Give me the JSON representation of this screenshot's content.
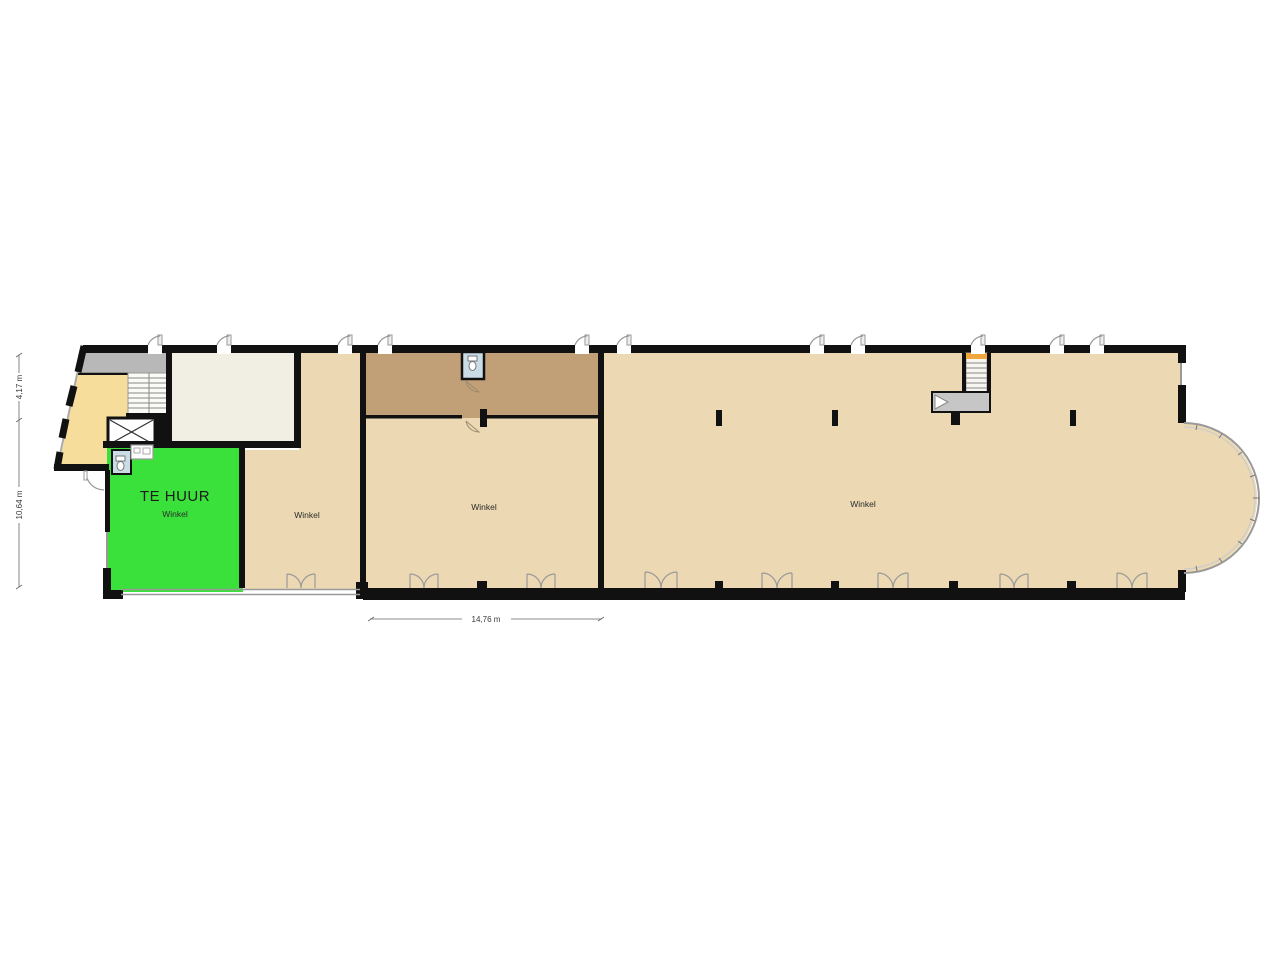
{
  "plan": {
    "rooms": {
      "te_huur": {
        "label": "TE HUUR",
        "sublabel": "Winkel"
      },
      "winkel_left": {
        "label": "Winkel"
      },
      "winkel_middle": {
        "label": "Winkel"
      },
      "winkel_right": {
        "label": "Winkel"
      }
    },
    "dimensions": {
      "upper_left": "4,17 m",
      "lower_left": "10,64 m",
      "bottom_middle": "14,76 m"
    },
    "colors": {
      "floor_beige": "#ecd9b3",
      "storage_brown": "#c2a077",
      "highlight_green": "#3be13b",
      "hall_yellow": "#f7dd9b",
      "walkway_gray": "#b8b8b8",
      "platform_gray": "#c6c6c6",
      "toilet_blue": "#cadde7",
      "room_cream": "#f1eee4",
      "stair_orange": "#f2a73e",
      "wall_black": "#111111"
    }
  }
}
